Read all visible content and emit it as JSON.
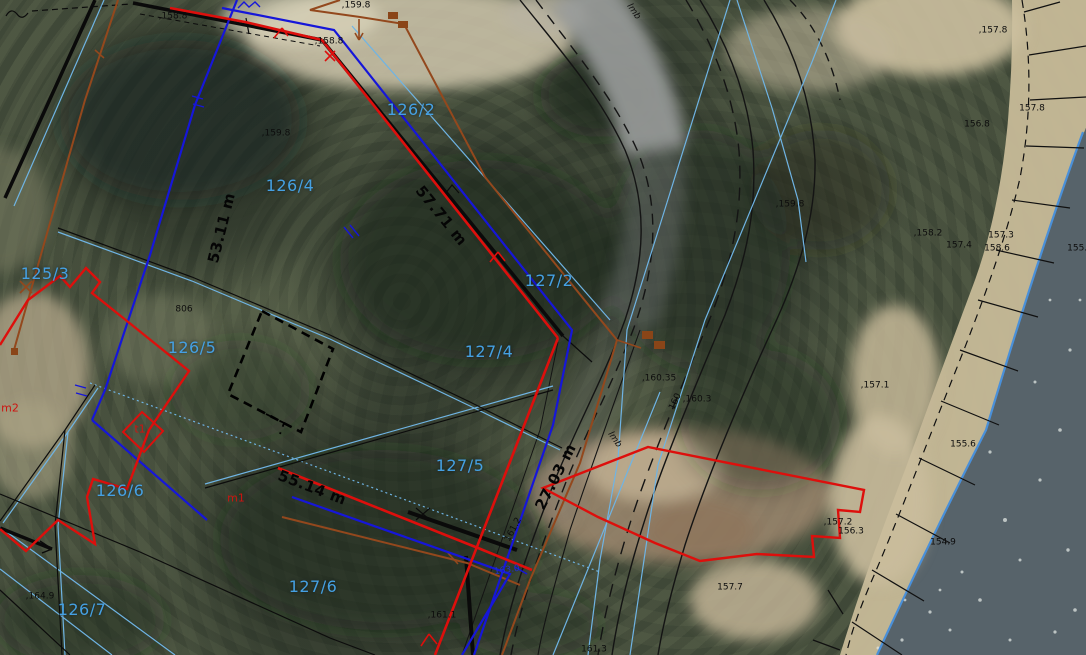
{
  "canvas": {
    "width": 1086,
    "height": 655
  },
  "map": {
    "type": "cadastral-aerial-overlay",
    "colors": {
      "boundary_red": "#dd0f0c",
      "utility_blue": "#1616d9",
      "parcel_line_light_blue": "#6fb4e4",
      "parcel_text_blue": "#45a0e2",
      "utility_brown": "#93481d",
      "boundary_black": "#0c0c0c",
      "water_edge_blue": "#4a90d9",
      "water_fill": "#57636a",
      "sand_fill": "#c7ba98",
      "road_fill": "#8b8e8f"
    },
    "parcels": [
      {
        "text": "126/2",
        "x": 411,
        "y": 110
      },
      {
        "text": "126/4",
        "x": 290,
        "y": 186
      },
      {
        "text": "125/3",
        "x": 45,
        "y": 274
      },
      {
        "text": "126/5",
        "x": 192,
        "y": 348
      },
      {
        "text": "126/6",
        "x": 120,
        "y": 491
      },
      {
        "text": "126/7",
        "x": 82,
        "y": 610
      },
      {
        "text": "127/2",
        "x": 549,
        "y": 281
      },
      {
        "text": "127/4",
        "x": 489,
        "y": 352
      },
      {
        "text": "127/5",
        "x": 460,
        "y": 466
      },
      {
        "text": "127/6",
        "x": 313,
        "y": 587
      }
    ],
    "measurements": [
      {
        "text": "53.11 m",
        "x": 222,
        "y": 228,
        "rot": -76
      },
      {
        "text": "57.71 m",
        "x": 441,
        "y": 216,
        "rot": 51
      },
      {
        "text": "55.14 m",
        "x": 312,
        "y": 488,
        "rot": 21
      },
      {
        "text": "27.03 m",
        "x": 556,
        "y": 477,
        "rot": -63
      }
    ],
    "spot_heights": [
      {
        "text": ",158.8",
        "x": 173,
        "y": 17
      },
      {
        "text": ",159.8",
        "x": 356,
        "y": 6
      },
      {
        "text": ",158.8",
        "x": 329,
        "y": 42
      },
      {
        "text": ",159.8",
        "x": 276,
        "y": 134
      },
      {
        "text": ",159.8",
        "x": 790,
        "y": 205
      },
      {
        "text": ",160.35",
        "x": 659,
        "y": 379
      },
      {
        "text": ",160.3",
        "x": 697,
        "y": 400
      },
      {
        "text": "160",
        "x": 676,
        "y": 402,
        "rot": -65
      },
      {
        "text": "806",
        "x": 184,
        "y": 310
      },
      {
        "text": "161.2",
        "x": 514,
        "y": 530,
        "rot": -62
      },
      {
        "text": ",161.1",
        "x": 442,
        "y": 616
      },
      {
        "text": "161.3",
        "x": 594,
        "y": 650
      },
      {
        "text": ",164.9",
        "x": 40,
        "y": 597
      },
      {
        "text": ",157.8",
        "x": 993,
        "y": 31
      },
      {
        "text": "157.8",
        "x": 1032,
        "y": 109
      },
      {
        "text": "156.8",
        "x": 977,
        "y": 125
      },
      {
        "text": ",158.2",
        "x": 928,
        "y": 234
      },
      {
        "text": "157.4",
        "x": 959,
        "y": 246
      },
      {
        "text": "157.3",
        "x": 1001,
        "y": 236
      },
      {
        "text": "158.6",
        "x": 997,
        "y": 249
      },
      {
        "text": "155.9",
        "x": 1080,
        "y": 249
      },
      {
        "text": ",157.1",
        "x": 875,
        "y": 386
      },
      {
        "text": ",157.2",
        "x": 838,
        "y": 523
      },
      {
        "text": "156.3",
        "x": 851,
        "y": 532
      },
      {
        "text": "154.9",
        "x": 943,
        "y": 543
      },
      {
        "text": "155.6",
        "x": 963,
        "y": 445
      },
      {
        "text": "157.7",
        "x": 730,
        "y": 588
      }
    ],
    "utility_labels": [
      {
        "text": "lmb",
        "x": 633,
        "y": 12,
        "rot": 55
      },
      {
        "text": "lmb",
        "x": 614,
        "y": 440,
        "rot": 55
      }
    ],
    "building_labels": [
      {
        "text": "m2",
        "x": 10,
        "y": 408
      },
      {
        "text": "m1",
        "x": 236,
        "y": 498
      },
      {
        "text": "t1",
        "x": 140,
        "y": 429
      }
    ],
    "blue_notes": [
      {
        "text": "163.0",
        "x": 507,
        "y": 571,
        "rot": -8
      }
    ]
  }
}
